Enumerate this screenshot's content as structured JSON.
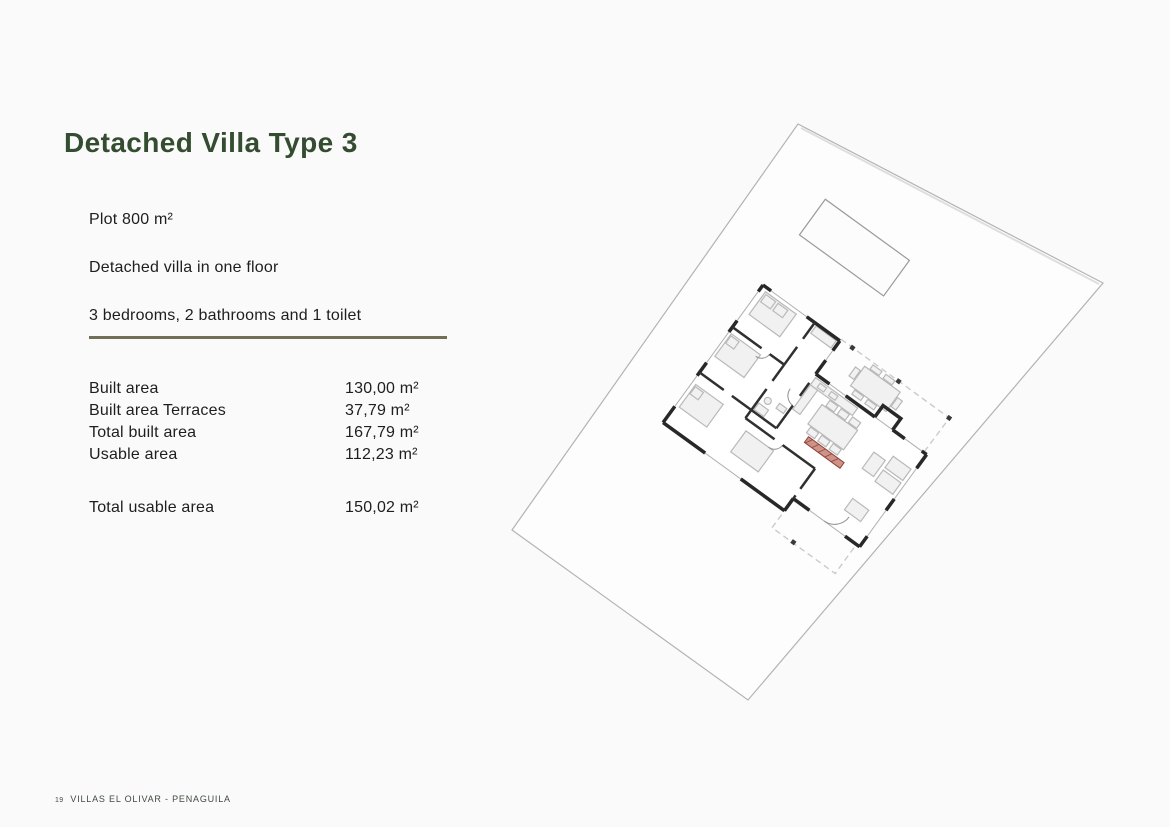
{
  "header": {
    "title": "Detached Villa Type 3"
  },
  "intro": {
    "plot": "Plot 800 m²",
    "floors": "Detached villa in one floor",
    "rooms": "3 bedrooms, 2 bathrooms and 1 toilet"
  },
  "areas": {
    "rows": [
      {
        "label": "Built area",
        "value": "130,00 m²"
      },
      {
        "label": "Built area Terraces",
        "value": "37,79 m²"
      },
      {
        "label": "Total built area",
        "value": "167,79 m²"
      },
      {
        "label": "Usable area",
        "value": "112,23 m²"
      }
    ],
    "total": {
      "label": "Total usable area",
      "value": "150,02 m²"
    }
  },
  "footer": {
    "page_number": "19",
    "project": "VILLAS EL OLIVAR - PENAGUILA"
  },
  "site_plan": {
    "description": "Rotated site plan: plot boundary, pool, one-floor villa floor plan with terrace pergola posts and red kitchen counter accent",
    "rotation_degrees": 36
  },
  "colors": {
    "background": "#fafafa",
    "title_green": "#344d31",
    "divider_olive": "#716f55",
    "body_text": "#1e1e1e",
    "plan_wall": "#282828",
    "plan_light": "#b9b9b9",
    "accent_red": "#8e4335"
  }
}
